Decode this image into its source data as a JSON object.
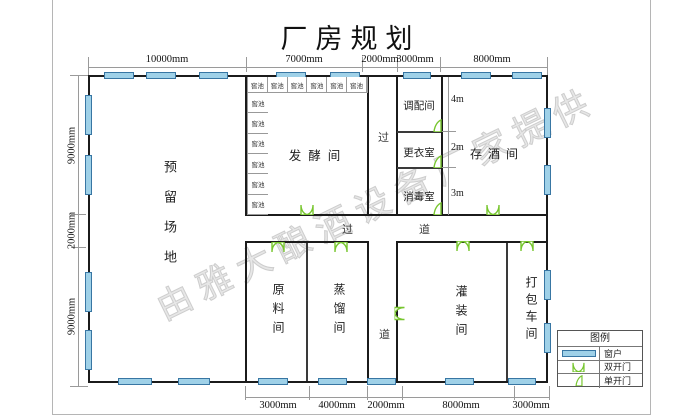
{
  "title": "厂房规划",
  "watermark": "由雅大酿酒设备厂家提供",
  "rooms": {
    "reserved": {
      "name": "预留场地"
    },
    "fermentation": {
      "name": "发酵间",
      "pit_label": "窖池"
    },
    "blending": {
      "name": "调配间"
    },
    "changing": {
      "name": "更衣室"
    },
    "disinfection": {
      "name": "消毒室"
    },
    "wine_storage": {
      "name": "存酒间"
    },
    "raw_material": {
      "name": "原料间"
    },
    "distillation": {
      "name": "蒸馏间"
    },
    "filling": {
      "name": "灌装间"
    },
    "packing": {
      "name": "打包车间"
    }
  },
  "corridor": {
    "v_top": "过",
    "v_bottom": "道",
    "h_left": "过",
    "h_right": "道"
  },
  "dims": {
    "top": [
      "10000mm",
      "7000mm",
      "2000mm",
      "3000mm",
      "8000mm"
    ],
    "bottom": [
      "3000mm",
      "4000mm",
      "2000mm",
      "8000mm",
      "3000mm"
    ],
    "left": [
      "9000mm",
      "2000mm",
      "9000mm"
    ],
    "inner": [
      "4m",
      "2m",
      "3m"
    ]
  },
  "legend": {
    "title": "图例",
    "items": [
      {
        "symbol": "window-icon",
        "label": "窗户"
      },
      {
        "symbol": "double-door-icon",
        "label": "双开门"
      },
      {
        "symbol": "single-door-icon",
        "label": "单开门"
      }
    ]
  },
  "colors": {
    "wall": "#1b1b1b",
    "window_fill": "#9FD1E8",
    "window_border": "#3876A3",
    "door_green": "#77C62E"
  }
}
